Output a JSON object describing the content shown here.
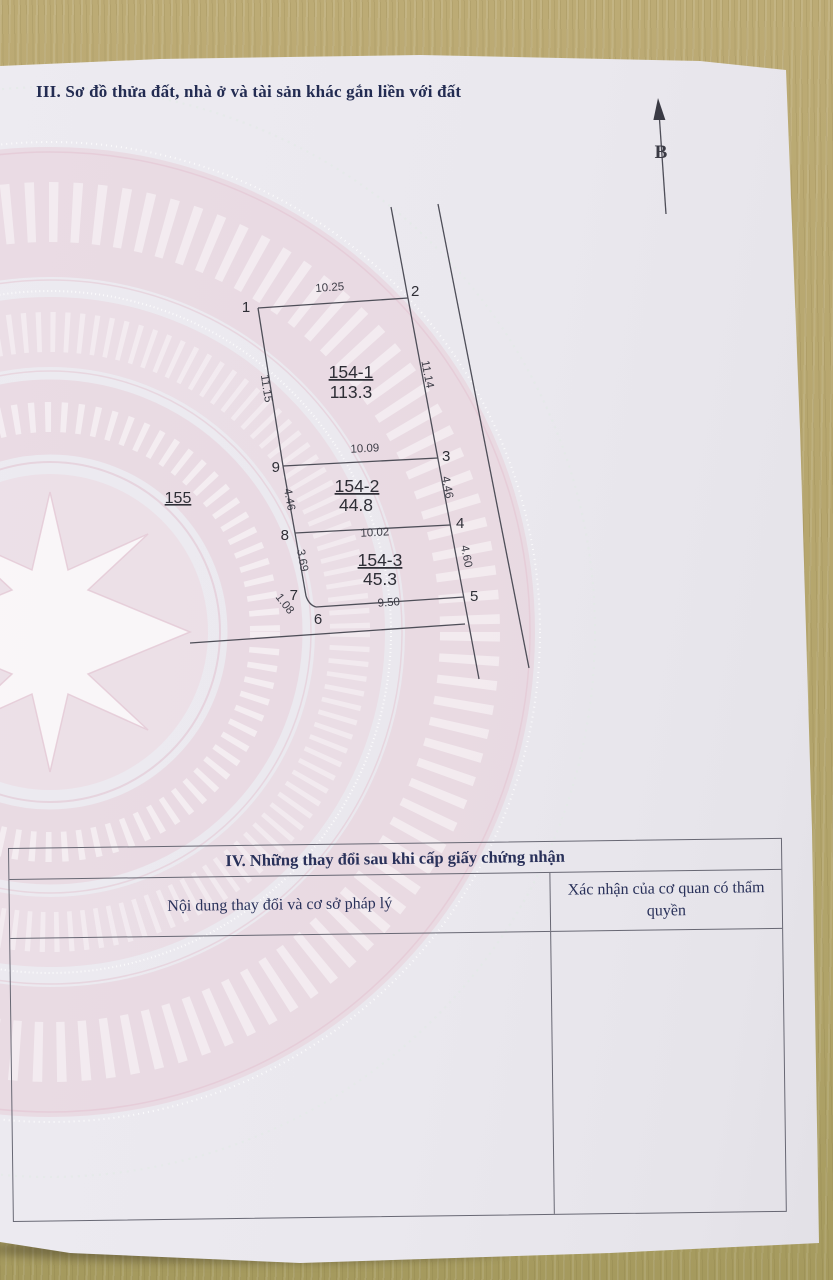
{
  "section3": {
    "title": "III. Sơ đồ thửa đất, nhà ở và tài sản khác gắn liền với đất"
  },
  "diagram": {
    "north_label": "B",
    "adjacent_parcel": "155",
    "parcels": [
      {
        "id": "154-1",
        "area": "113.3"
      },
      {
        "id": "154-2",
        "area": "44.8"
      },
      {
        "id": "154-3",
        "area": "45.3"
      }
    ],
    "points": {
      "p1": "1",
      "p2": "2",
      "p3": "3",
      "p4": "4",
      "p5": "5",
      "p6": "6",
      "p7": "7",
      "p8": "8",
      "p9": "9"
    },
    "dims": {
      "d1_2": "10.25",
      "d1_9": "11.15",
      "d2_3": "11.14",
      "d9_3": "10.09",
      "d9_8": "4.46",
      "d3_4": "4.46",
      "d8_4": "10.02",
      "d8_7": "3.69",
      "d4_5": "4.60",
      "d7_6": "1.08",
      "d6_5": "9.50"
    }
  },
  "section4": {
    "title": "IV. Những thay đổi sau khi cấp giấy chứng nhận",
    "col1_header": "Nội dung thay đổi và cơ sở pháp lý",
    "col2_header": "Xác nhận của cơ quan có thẩm quyền"
  },
  "colors": {
    "heading_navy": "#232c52",
    "table_navy": "#29315a",
    "diagram_line": "#4e4e58",
    "watermark_pink": "#e7cdd8",
    "paper": "#eae8ee",
    "wood": "#b6a66e"
  }
}
